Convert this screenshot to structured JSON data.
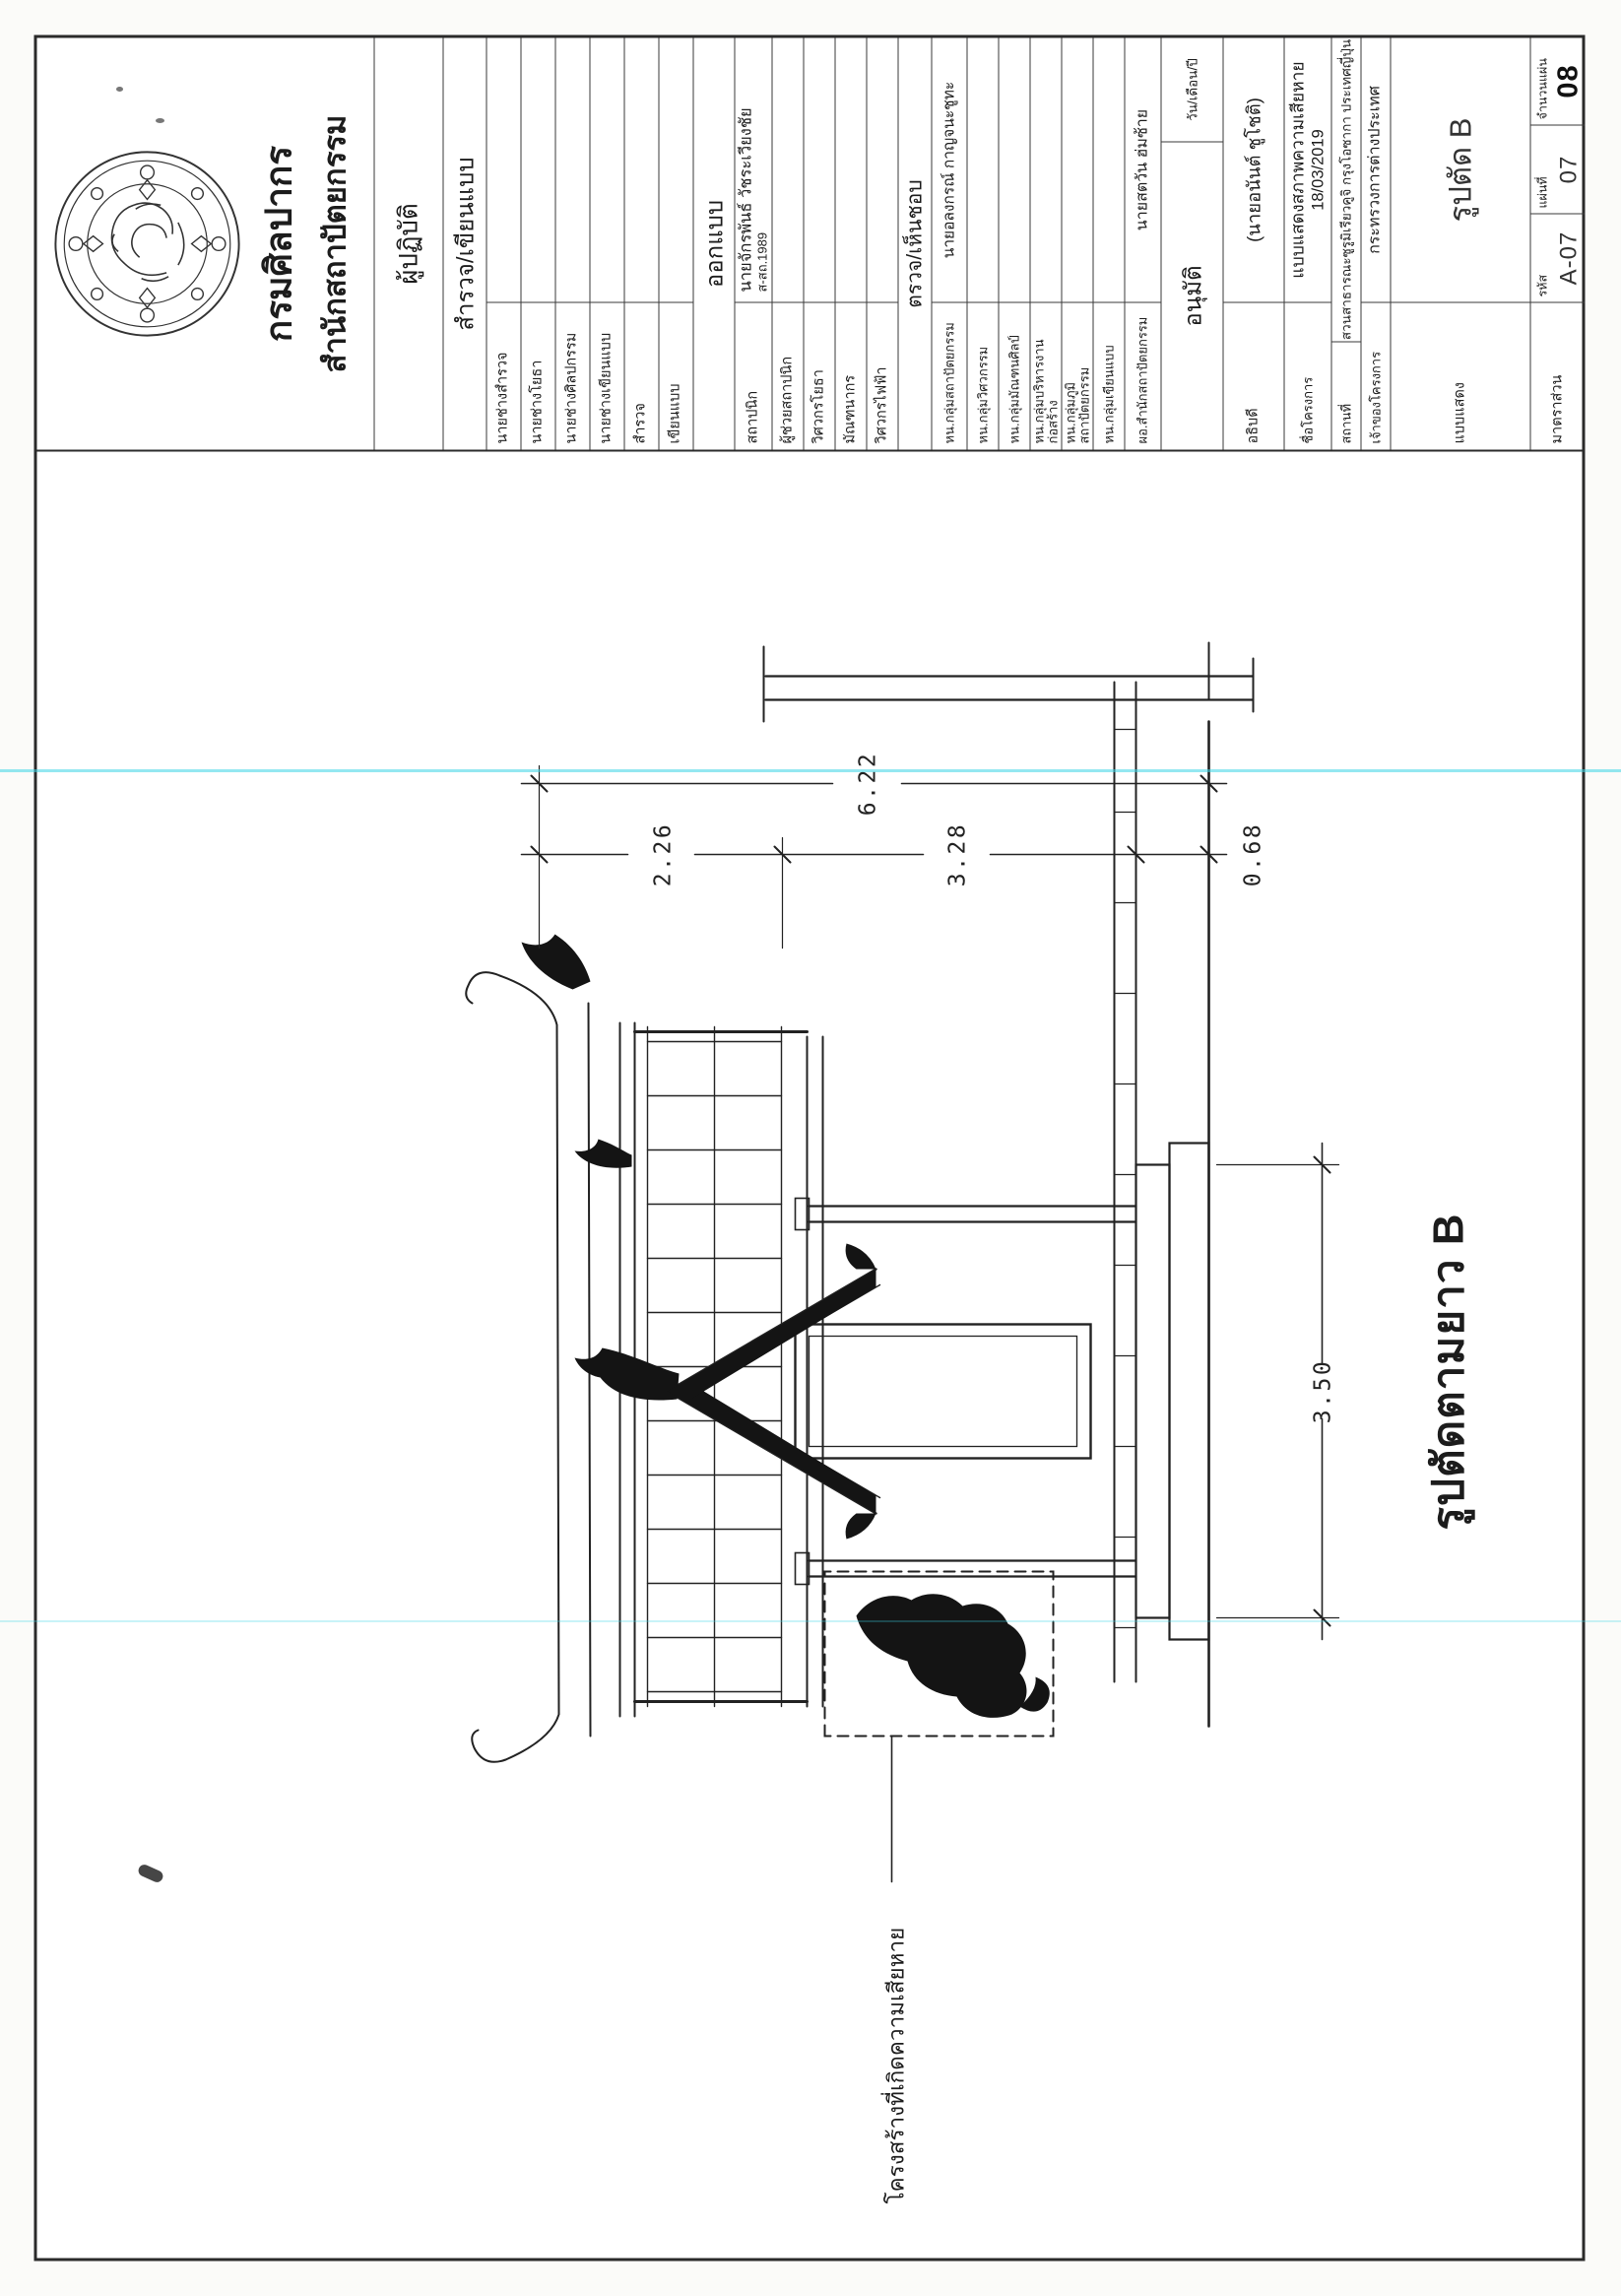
{
  "agency": {
    "emblem_icon": "fine-arts-department-seal",
    "name_line1": "กรมศิลปากร",
    "name_line2": "สำนักสถาปัตยกรรม"
  },
  "title_block": {
    "operator_header": "ผู้ปฏิบัติ",
    "survey_header": "สำรวจ/เขียนแบบ",
    "survey_rows": [
      {
        "label": "นายช่างสำรวจ"
      },
      {
        "label": "นายช่างโยธา"
      },
      {
        "label": "นายช่างศิลปกรรม"
      },
      {
        "label": "นายช่างเขียนแบบ"
      },
      {
        "label": "สำรวจ"
      },
      {
        "label": "เขียนแบบ"
      }
    ],
    "design_header": "ออกแบบ",
    "design_rows": [
      {
        "label": "สถาปนิก",
        "name": "นายจักรพันธ์ วัชระเวียงชัย",
        "license": "ส-สถ.1989"
      },
      {
        "label": "ผู้ช่วยสถาปนิก",
        "name": ""
      },
      {
        "label": "วิศวกรโยธา",
        "name": ""
      },
      {
        "label": "มัณฑนากร",
        "name": ""
      },
      {
        "label": "วิศวกรไฟฟ้า",
        "name": ""
      }
    ],
    "review_header": "ตรวจ/เห็นชอบ",
    "review_rows": [
      {
        "label": "หน.กลุ่มสถาปัตยกรรม",
        "name": "นายอลงกรณ์ กาญจนะชูทะ"
      },
      {
        "label": "หน.กลุ่มวิศวกรรม",
        "name": ""
      },
      {
        "label": "หน.กลุ่มมัณฑนศิลป์",
        "name": ""
      },
      {
        "label": "หน.กลุ่มบริหารงานก่อสร้าง",
        "name": ""
      },
      {
        "label": "หน.กลุ่มภูมิสถาปัตยกรรม",
        "name": ""
      },
      {
        "label": "หน.กลุ่มเขียนแบบ",
        "name": ""
      },
      {
        "label": "ผอ.สำนักสถาปัตยกรรม",
        "name": "นายสตวัน ฮ่มซ้าย"
      }
    ],
    "approve_header": "อนุมัติ",
    "date_header": "วัน/เดือน/ปี",
    "approve_row": {
      "label": "อธิบดี",
      "name": "(นายอนันต์ ชูโชติ)"
    },
    "project": {
      "name_label": "ชื่อโครงการ",
      "name_value": "แบบแสดงสภาพความเสียหาย",
      "date_value": "18/03/2019",
      "location_label": "สถานที่",
      "location_value": "สวนสาธารณะซูรูมิเรียวคูจิ กรุงโอซากา ประเทศญี่ปุ่น",
      "owner_label": "เจ้าของโครงการ",
      "owner_value": "กระทรวงการต่างประเทศ"
    },
    "sheet": {
      "type_label": "แบบแสดง",
      "type_value": "รูปตัด B",
      "scale_label": "มาตราส่วน",
      "code_label": "รหัส",
      "code_value": "A-07",
      "sheet_label": "แผ่นที่",
      "sheet_value": "07",
      "total_label": "จำนวนแผ่น",
      "total_value": "08"
    }
  },
  "drawing": {
    "title": "รูปตัดตามยาว B",
    "damage_note": "โครงสร้างที่เกิดความเสียหาย",
    "dimensions": {
      "total_height": "6.22",
      "roof": "2.26",
      "body": "3.28",
      "base": "0.68",
      "width": "3.50"
    }
  },
  "colors": {
    "ink": "#1c1c1c",
    "scan_line_cyan": "#3cd5e6"
  }
}
